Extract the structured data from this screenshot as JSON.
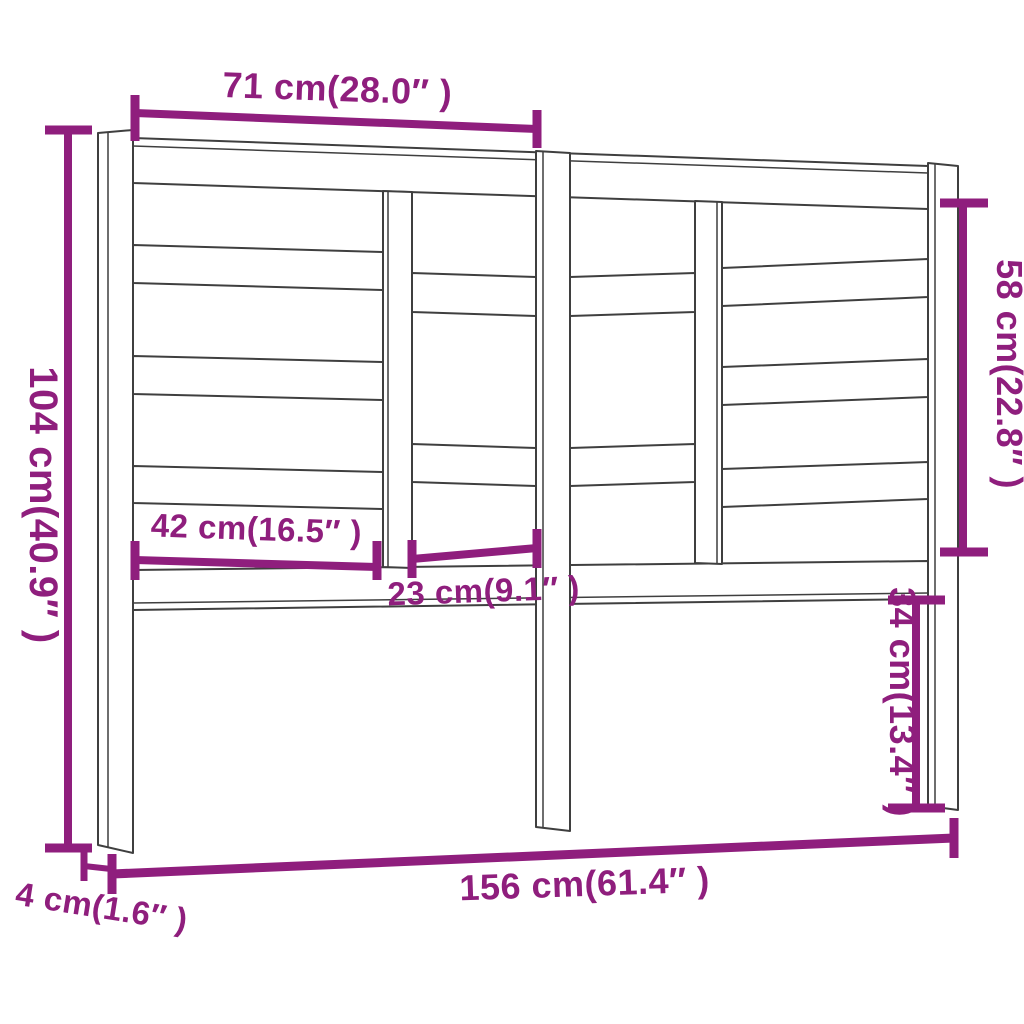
{
  "diagram": {
    "type": "product-dimension-drawing",
    "subject": "bed headboard with staggered horizontal slats, three legs",
    "colors": {
      "dimension": "#8f1e7d",
      "outline": "#3f3f3f",
      "background": "#ffffff"
    },
    "dimensions": {
      "top_section_width": {
        "label": "71 cm(28.0″ )",
        "value_cm": 71,
        "value_inch": 28.0
      },
      "overall_height": {
        "label": "104 cm(40.9″ )",
        "value_cm": 104,
        "value_inch": 40.9
      },
      "panel_height": {
        "label": "58 cm(22.8″ )",
        "value_cm": 58,
        "value_inch": 22.8
      },
      "wide_opening_width": {
        "label": "42 cm(16.5″ )",
        "value_cm": 42,
        "value_inch": 16.5
      },
      "inner_opening_width": {
        "label": "23 cm(9.1″ )",
        "value_cm": 23,
        "value_inch": 9.1
      },
      "leg_height": {
        "label": "34 cm(13.4″ )",
        "value_cm": 34,
        "value_inch": 13.4
      },
      "overall_width": {
        "label": "156 cm(61.4″ )",
        "value_cm": 156,
        "value_inch": 61.4
      },
      "depth": {
        "label": "4 cm(1.6″ )",
        "value_cm": 4,
        "value_inch": 1.6
      }
    }
  }
}
